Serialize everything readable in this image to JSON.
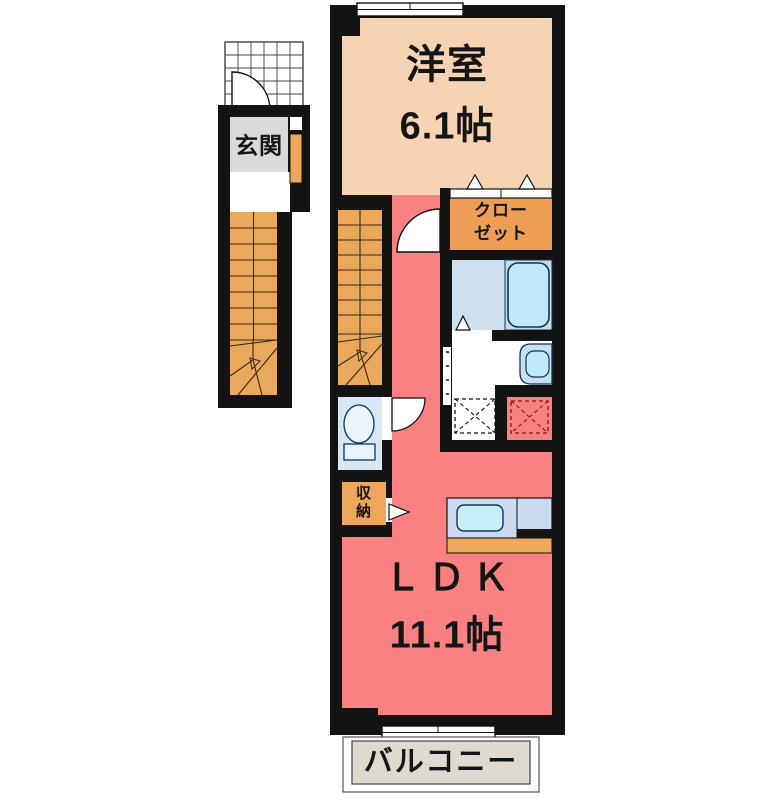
{
  "floor_plan": {
    "title": "apartment-floor-plan",
    "wall_color": "#131313",
    "background": "#ffffff",
    "rooms": {
      "western_room": {
        "label": "洋室",
        "size": "6.1帖",
        "color": "#F6D3B2"
      },
      "closet": {
        "label": "クロー\nゼット",
        "color": "#EE9D55"
      },
      "entrance": {
        "label": "玄関",
        "color": "#DADADA"
      },
      "storage": {
        "label": "収\n納",
        "color": "#EEA55C"
      },
      "ldk": {
        "label": "ＬＤＫ",
        "size": "11.1帖",
        "color": "#F98181"
      },
      "balcony": {
        "label": "バルコニー",
        "color": "#DEDAD0"
      },
      "bathroom": {
        "color": "#CFE1F1",
        "bathtub_color": "#BEEAF7"
      },
      "toilet": {
        "color": "#D6E7F6"
      },
      "stairs": {
        "color": "#E9A85C"
      },
      "kitchen": {
        "counter_color": "#CCDAEF",
        "sink_color": "#C8EFF9",
        "base_color": "#EFA85C"
      }
    }
  }
}
